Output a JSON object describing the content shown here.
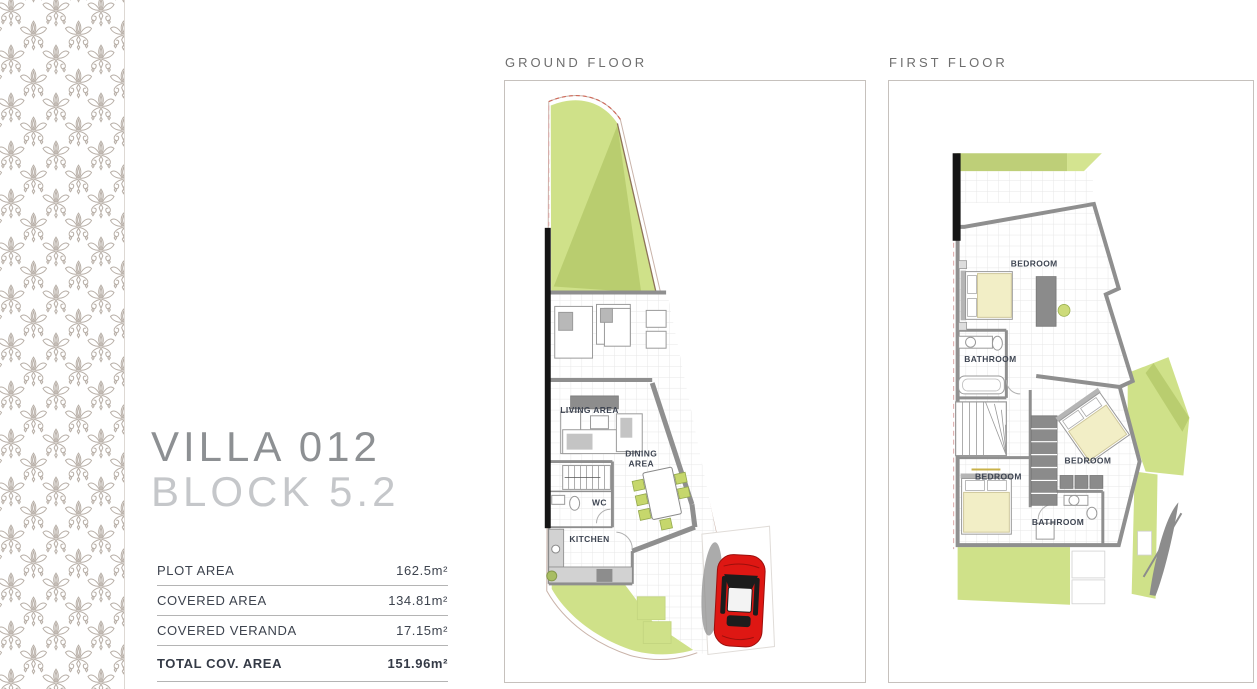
{
  "villa": {
    "name": "VILLA 012",
    "block": "BLOCK 5.2"
  },
  "area_table": {
    "rows": [
      {
        "label": "PLOT AREA",
        "value": "162.5m²"
      },
      {
        "label": "COVERED AREA",
        "value": "134.81m²"
      },
      {
        "label": "COVERED VERANDA",
        "value": "17.15m²"
      },
      {
        "label": "TOTAL COV. AREA",
        "value": "151.96m²"
      }
    ]
  },
  "ground_floor": {
    "heading": "GROUND FLOOR",
    "labels": {
      "living": "LIVING AREA",
      "dining_line1": "DINING",
      "dining_line2": "AREA",
      "wc": "WC",
      "kitchen": "KITCHEN"
    }
  },
  "first_floor": {
    "heading": "FIRST FLOOR",
    "labels": {
      "bedroom_top": "BEDROOM",
      "bathroom_top": "BATHROOM",
      "bedroom_left": "BEDROOM",
      "bedroom_right": "BEDROOM",
      "bathroom_bottom": "BATHROOM"
    }
  },
  "colors": {
    "garden_green": "#cfe189",
    "garden_dark": "#b9cd6f",
    "pattern_taupe": "#b7aea6",
    "car_red": "#de1713",
    "wall_gray": "#8f8f8f",
    "title_gray": "#8d9093",
    "subtitle_gray": "#c5c7ca",
    "text_dark": "#3d434e"
  }
}
